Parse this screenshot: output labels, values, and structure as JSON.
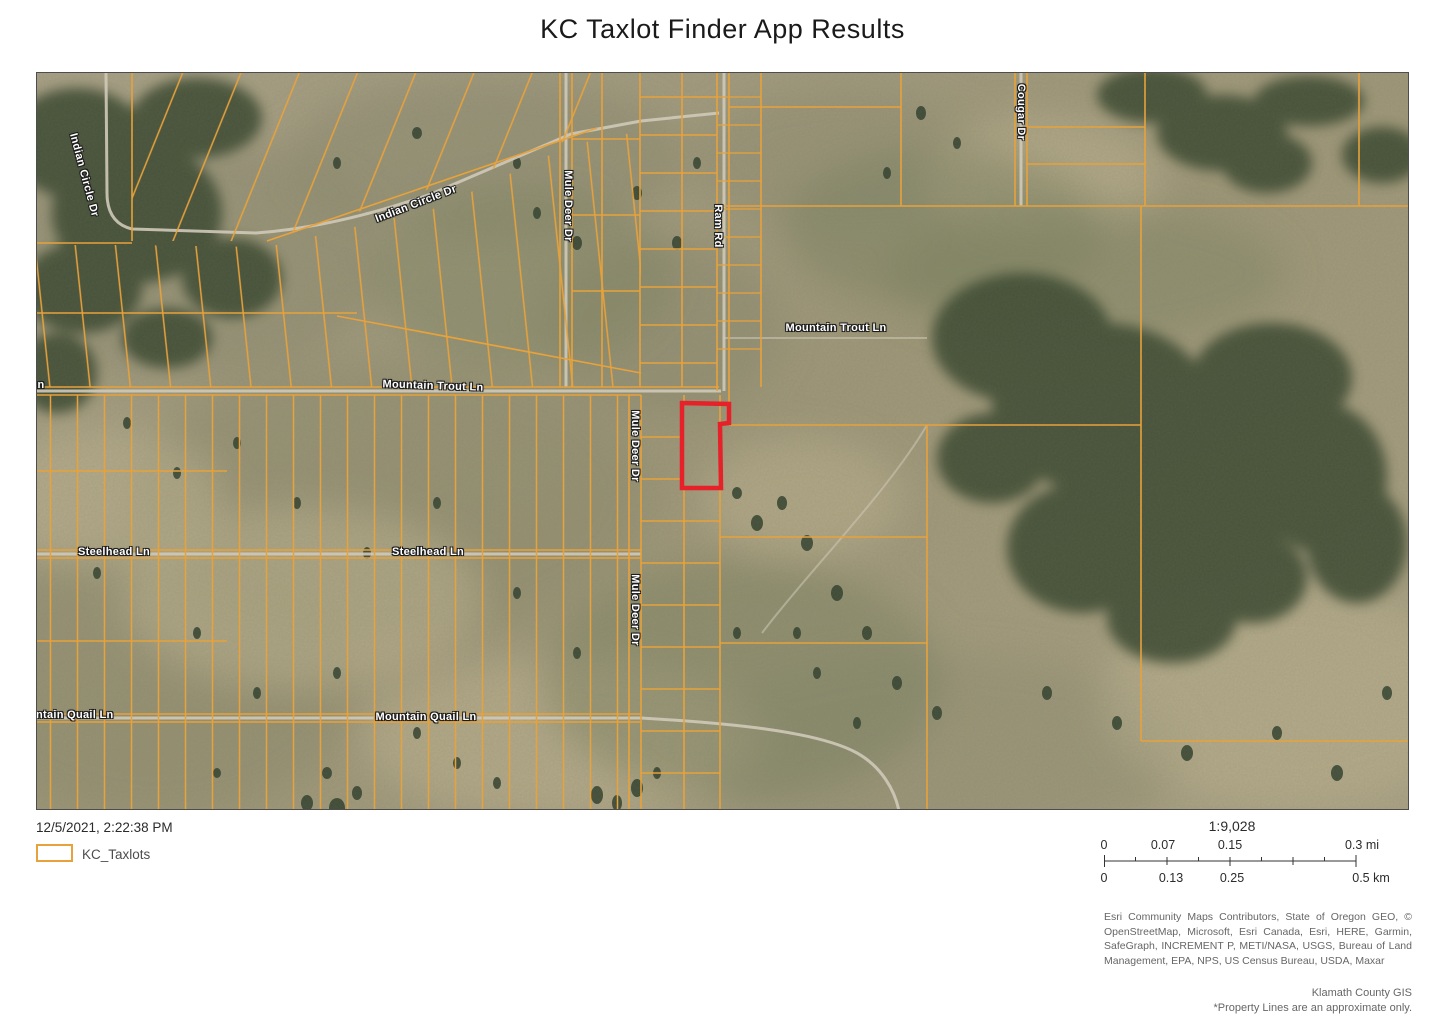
{
  "title": "KC Taxlot Finder App Results",
  "map": {
    "labels": [
      {
        "text": "Indian Circle Dr"
      },
      {
        "text": "Indian Circle Dr"
      },
      {
        "text": "Mule Deer Dr"
      },
      {
        "text": "Ram Rd"
      },
      {
        "text": "Cougar Dr"
      },
      {
        "text": "Mountain Trout Ln"
      },
      {
        "text": "Mountain Trout Ln"
      },
      {
        "text": "Mountain Trout Ln"
      },
      {
        "text": "Steelhead Ln"
      },
      {
        "text": "Steelhead Ln"
      },
      {
        "text": "Mule Deer Dr"
      },
      {
        "text": "Mule Deer Dr"
      },
      {
        "text": "Mountain Quail Ln"
      },
      {
        "text": "Mountain Quail Ln"
      }
    ]
  },
  "legend": {
    "timestamp": "12/5/2021, 2:22:38 PM",
    "item_label": "KC_Taxlots"
  },
  "scale": {
    "ratio": "1:9,028",
    "miles": [
      "0",
      "0.07",
      "0.15",
      "0.3 mi"
    ],
    "km": [
      "0",
      "0.13",
      "0.25",
      "0.5 km"
    ]
  },
  "attribution": {
    "sources": "Esri Community Maps Contributors, State of Oregon GEO, © OpenStreetMap, Microsoft, Esri Canada, Esri, HERE, Garmin, SafeGraph, INCREMENT P, METI/NASA, USGS, Bureau of Land Management, EPA, NPS, US Census Bureau, USDA, Maxar",
    "agency": "Klamath County GIS",
    "disclaimer": "*Property Lines are an approximate only."
  },
  "colors": {
    "taxlot": "#E8A23B",
    "highlight": "#E62129",
    "road": "#CFC9B8"
  }
}
